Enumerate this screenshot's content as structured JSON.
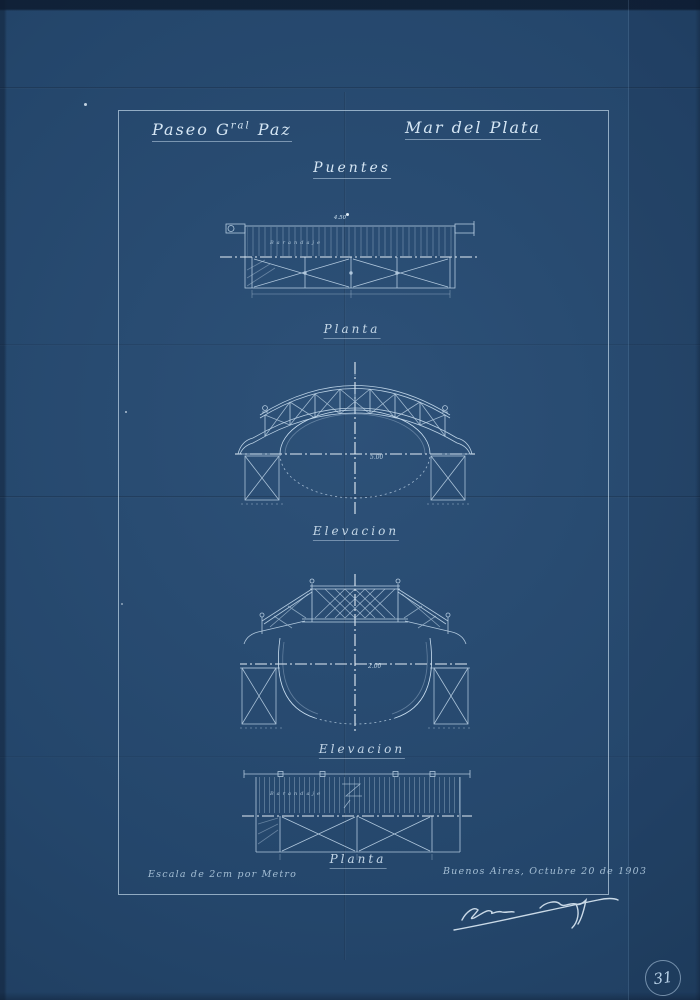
{
  "header": {
    "title_left": {
      "pre": "Paseo G",
      "sup": "ral",
      "post": " Paz"
    },
    "title_right": "Mar del Plata",
    "subtitle": "Puentes"
  },
  "drawings": [
    {
      "caption": "Planta",
      "annotation": "Barandaje",
      "dimension": "4.50"
    },
    {
      "caption": "Elevacion",
      "dimension": "5.00"
    },
    {
      "caption": "Elevacion",
      "dimension": "2.00"
    },
    {
      "caption": "Planta",
      "annotation": "Barandaje"
    }
  ],
  "footer": {
    "scale_note": "Escala de 2cm por Metro",
    "place_date": "Buenos Aires, Octubre 20 de 1903"
  },
  "sheet_number": "31",
  "colors": {
    "paper": "#24466b",
    "paper_dark": "#152e4c",
    "ink": "#c9def0",
    "ink_bright": "#eef6fc"
  }
}
